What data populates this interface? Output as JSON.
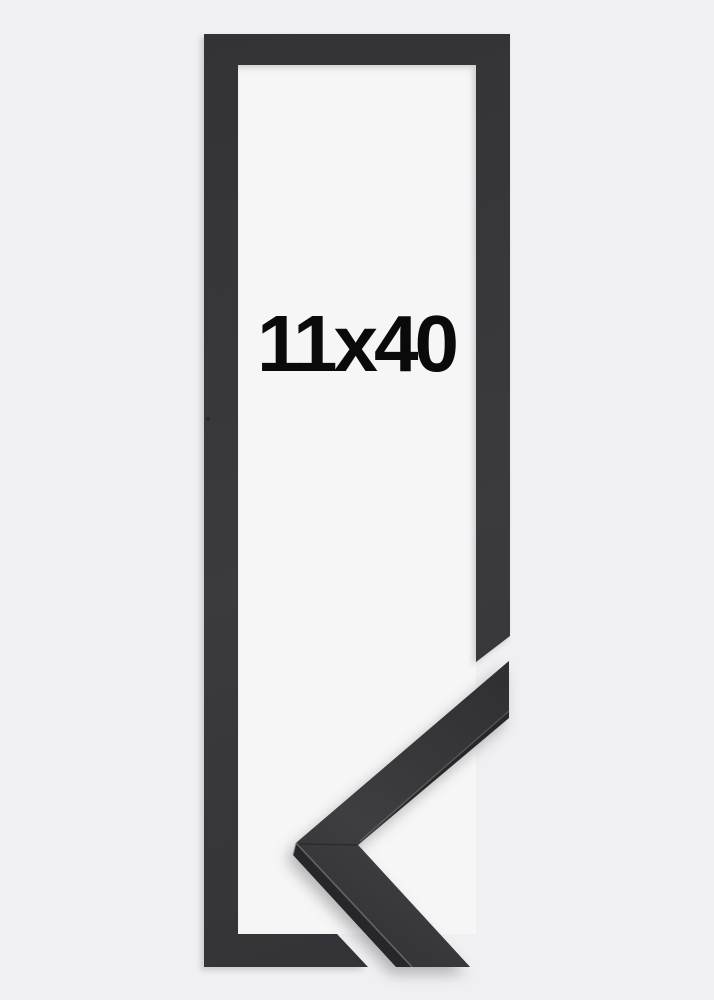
{
  "product": {
    "size_label": "11x40"
  },
  "colors": {
    "background": "#f0f0f2",
    "opening": "#f6f6f7",
    "frame_light": "#3b3b3e",
    "frame_dark": "#333336",
    "corner_side": "#27272a",
    "corner_top_dark": "#2f2f32",
    "corner_top_light": "#3e3e41",
    "edge_highlight": "#9a9a9f",
    "miter_seam": "#161618",
    "speck": "#1d1d1f",
    "label_text": "#0a0a0b"
  }
}
